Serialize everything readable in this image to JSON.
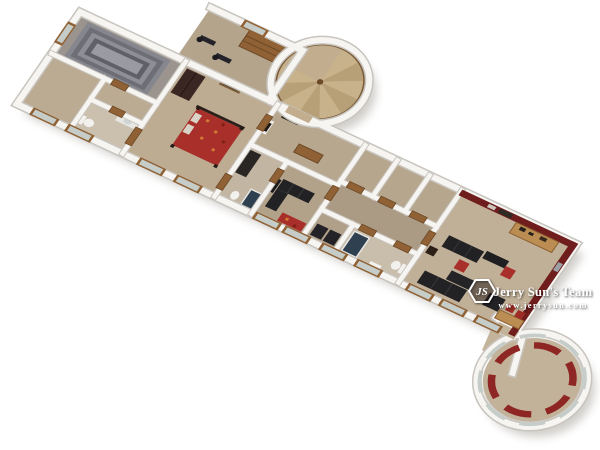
{
  "watermark": {
    "team_name": "Jerry Sun's Team",
    "website": "www.jerrysun.com",
    "monogram": "JS"
  },
  "colors": {
    "background": "#ffffff",
    "wall": "#f7f5f2",
    "wall_edge": "#c8c4be",
    "floor": "#b9a88f",
    "floor_light": "#c7b89f",
    "floor_dark": "#ab9a84",
    "accent_wall": "#6f1d1d",
    "red_fabric": "#a9302a",
    "sofa_black": "#222124",
    "wood": "#8f6134",
    "wood_light": "#bb8d52",
    "wood_dark": "#3a2723",
    "stair_gray": "#77777f",
    "glass": "#c6cdc9",
    "shower_glass": "#2f4050",
    "shadow": "#8b857c",
    "watermark_text": "#ffffff"
  }
}
